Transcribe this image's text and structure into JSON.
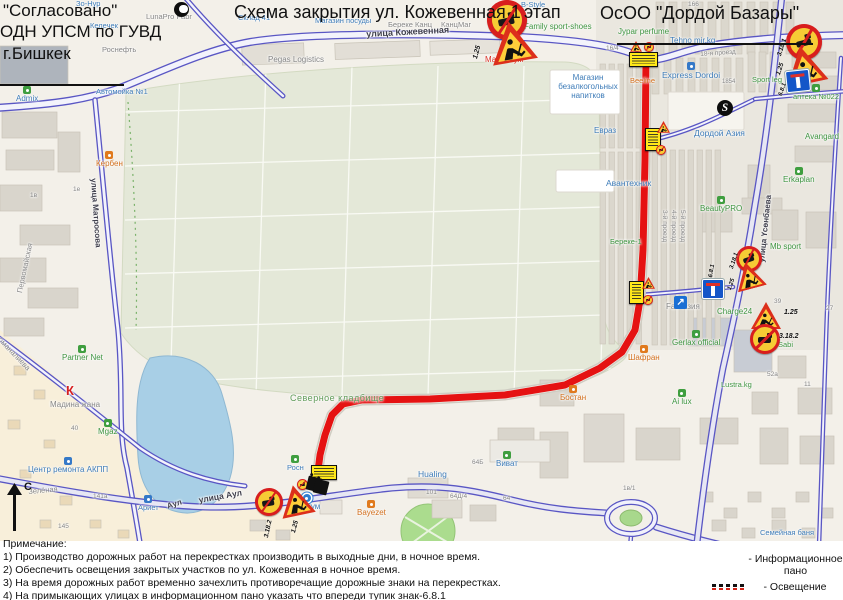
{
  "approval": {
    "line1": "\"Согласовано\"",
    "line2": "ОДН УПСМ по ГУВД",
    "line3": "г.Бишкек"
  },
  "scheme_title": {
    "part1": "Схема закрытия ул. Кожевенная 1",
    "part2": "этап"
  },
  "org_title": "ОсОО \"Дордой Базары\"",
  "compass": {
    "label": "С"
  },
  "notes": {
    "heading": "Примечание:",
    "items": [
      "1) Производство дорожных работ на перекрестках производить в выходные дни, в ночное время.",
      "2) Обеспечить освещения закрытых участков по ул. Кожевенная в ночное время.",
      "3) На время дорожных работ временно зачехлить противоречащие дорожные знаки на перекрестках.",
      "4) На примыкающих улицах в информационном пано указать что впереди тупик знак-6.8.1"
    ]
  },
  "legend": {
    "info_label": "- Информационное\nпано",
    "light_label": "-  Освещение",
    "panel1": "ВНИМАНИЕ!\nВ связи с ремонтными\nработами проезд\nЗАКРЫТ!\nПриносим извинения за\nвременные неудобства.",
    "panel2": "ВНИМАНИЕ!\nВ связи с ремонтными\nработами проезд по\nдругой стороне улицы.\nПриносим извинения за\nвременные неудобства."
  },
  "map": {
    "route": [
      [
        646,
        58
      ],
      [
        645,
        160
      ],
      [
        643,
        250
      ],
      [
        640,
        300
      ],
      [
        635,
        330
      ],
      [
        622,
        352
      ],
      [
        600,
        368
      ],
      [
        565,
        385
      ],
      [
        505,
        395
      ],
      [
        430,
        399
      ],
      [
        362,
        400
      ],
      [
        343,
        404
      ],
      [
        332,
        415
      ],
      [
        325,
        435
      ],
      [
        320,
        455
      ],
      [
        318,
        471
      ]
    ],
    "labels": [
      {
        "t": "Зо-Нур",
        "x": 76,
        "y": 0,
        "c": "blue",
        "s": 7.5
      },
      {
        "t": "LunaPro Fabr",
        "x": 146,
        "y": 13,
        "c": "gray",
        "s": 7.5
      },
      {
        "t": "Склад 41",
        "x": 238,
        "y": 14,
        "c": "blue",
        "s": 7.5
      },
      {
        "t": "Келечек",
        "x": 90,
        "y": 22,
        "c": "blue",
        "s": 7.5
      },
      {
        "t": "Роснефть",
        "x": 102,
        "y": 46,
        "c": "gray",
        "s": 7.5
      },
      {
        "t": "Автомойка №1",
        "x": 96,
        "y": 88,
        "c": "blue",
        "s": 7.5
      },
      {
        "t": "Admix",
        "x": 16,
        "y": 86,
        "c": "blue",
        "s": 8,
        "icon": "green"
      },
      {
        "t": "Магазин посуды",
        "x": 315,
        "y": 17,
        "c": "blue",
        "s": 7.5
      },
      {
        "t": "Береке Канц",
        "x": 388,
        "y": 21,
        "c": "gray",
        "s": 7.5
      },
      {
        "t": "КанцМаг",
        "x": 441,
        "y": 21,
        "c": "gray",
        "s": 7.5
      },
      {
        "t": "Pegas Logistics",
        "x": 268,
        "y": 56,
        "c": "gray",
        "s": 8
      },
      {
        "t": "Максимум",
        "x": 485,
        "y": 56,
        "c": "red",
        "s": 8
      },
      {
        "t": "B-Style",
        "x": 521,
        "y": 1,
        "c": "blue",
        "s": 7.5
      },
      {
        "t": "Family sport-shoes",
        "x": 524,
        "y": 23,
        "c": "green",
        "s": 8
      },
      {
        "t": "Jypar perfume",
        "x": 618,
        "y": 28,
        "c": "green",
        "s": 8
      },
      {
        "t": "Tehno mir.kg",
        "x": 670,
        "y": 37,
        "c": "blue",
        "s": 8
      },
      {
        "t": "Express Dordoi",
        "x": 662,
        "y": 62,
        "c": "blue",
        "s": 8.5,
        "icon": "blue"
      },
      {
        "t": "Beeline",
        "x": 630,
        "y": 77,
        "c": "orange",
        "s": 7.5
      },
      {
        "t": "Магазин\nбезалкогольных\nнапитков",
        "x": 550,
        "y": 74,
        "c": "blue",
        "s": 8,
        "w": 76
      },
      {
        "t": "аптека №022",
        "x": 793,
        "y": 84,
        "c": "green",
        "s": 7.5,
        "icon": "green"
      },
      {
        "t": "Sport leg",
        "x": 752,
        "y": 76,
        "c": "green",
        "s": 7.5
      },
      {
        "t": "Avangard",
        "x": 805,
        "y": 133,
        "c": "green",
        "s": 8
      },
      {
        "t": "Erkaplan",
        "x": 783,
        "y": 167,
        "c": "green",
        "s": 8,
        "icon": "green"
      },
      {
        "t": "BeautyPRO",
        "x": 700,
        "y": 196,
        "c": "green",
        "s": 8,
        "icon": "green"
      },
      {
        "t": "Дордой Азия",
        "x": 694,
        "y": 129,
        "c": "blue",
        "s": 8.5
      },
      {
        "t": "Евраз",
        "x": 594,
        "y": 127,
        "c": "blue",
        "s": 8
      },
      {
        "t": "Авантехник",
        "x": 606,
        "y": 179,
        "c": "blue",
        "s": 8.5
      },
      {
        "t": "Береке-1",
        "x": 610,
        "y": 238,
        "c": "green",
        "s": 7.5
      },
      {
        "t": "Mb sport",
        "x": 770,
        "y": 243,
        "c": "green",
        "s": 8
      },
      {
        "t": "Fan Азия",
        "x": 666,
        "y": 303,
        "c": "gray",
        "s": 8
      },
      {
        "t": "Charge24",
        "x": 717,
        "y": 308,
        "c": "green",
        "s": 8
      },
      {
        "t": "Gerlax official",
        "x": 672,
        "y": 330,
        "c": "green",
        "s": 8,
        "icon": "green"
      },
      {
        "t": "Шафран",
        "x": 628,
        "y": 345,
        "c": "orange",
        "s": 8,
        "icon": "orange"
      },
      {
        "t": "Sabi",
        "x": 778,
        "y": 341,
        "c": "green",
        "s": 7.5
      },
      {
        "t": "Lustra.kg",
        "x": 721,
        "y": 381,
        "c": "green",
        "s": 7.5
      },
      {
        "t": "Ai lux",
        "x": 672,
        "y": 389,
        "c": "green",
        "s": 8,
        "icon": "green"
      },
      {
        "t": "Бостан",
        "x": 560,
        "y": 385,
        "c": "orange",
        "s": 8,
        "icon": "orange"
      },
      {
        "t": "Виват",
        "x": 496,
        "y": 451,
        "c": "blue",
        "s": 8,
        "icon": "green"
      },
      {
        "t": "Hualing",
        "x": 418,
        "y": 470,
        "c": "blue",
        "s": 8.5
      },
      {
        "t": "Bayezet",
        "x": 357,
        "y": 500,
        "c": "orange",
        "s": 8,
        "icon": "orange"
      },
      {
        "t": "Суйкум",
        "x": 293,
        "y": 494,
        "c": "blue",
        "s": 8,
        "icon": "bluedot"
      },
      {
        "t": "Северное кладбище",
        "x": 290,
        "y": 393,
        "c": "cem",
        "s": 9
      },
      {
        "t": "Росн",
        "x": 287,
        "y": 455,
        "c": "blue",
        "s": 7.5,
        "icon": "green"
      },
      {
        "t": "Partner Net",
        "x": 62,
        "y": 345,
        "c": "green",
        "s": 8,
        "icon": "green"
      },
      {
        "t": "Мадина жана",
        "x": 50,
        "y": 401,
        "c": "gray",
        "s": 8
      },
      {
        "t": "К",
        "x": 66,
        "y": 384,
        "c": "klogo",
        "s": 13
      },
      {
        "t": "Mgaz",
        "x": 98,
        "y": 419,
        "c": "green",
        "s": 8,
        "icon": "green"
      },
      {
        "t": "Центр ремонта АКПП",
        "x": 28,
        "y": 457,
        "c": "blue",
        "s": 8,
        "icon": "blue"
      },
      {
        "t": "Зелёная",
        "x": 28,
        "y": 488,
        "c": "gray",
        "s": 7.5,
        "rot": -5
      },
      {
        "t": "Ариет",
        "x": 138,
        "y": 495,
        "c": "blue",
        "s": 7.5,
        "icon": "blue"
      },
      {
        "t": "Кербен",
        "x": 96,
        "y": 151,
        "c": "orange",
        "s": 8,
        "icon": "orange"
      },
      {
        "t": "Семейная баня",
        "x": 760,
        "y": 529,
        "c": "blue",
        "s": 7.5
      },
      {
        "t": "Первомайская",
        "x": 16,
        "y": 292,
        "c": "gray",
        "s": 7.5,
        "rot": -78
      },
      {
        "t": "оманалиева",
        "x": 2,
        "y": 336,
        "c": "gray",
        "s": 7.5,
        "rot": 46
      },
      {
        "t": "улица Кожевенная",
        "x": 366,
        "y": 29,
        "c": "street",
        "s": 9,
        "rot": -3
      },
      {
        "t": "улица Аул",
        "x": 198,
        "y": 496,
        "c": "street",
        "s": 8.5,
        "rot": -10
      },
      {
        "t": "Аул",
        "x": 166,
        "y": 503,
        "c": "street",
        "s": 8,
        "rot": -18
      },
      {
        "t": "улица Матросова",
        "x": 97,
        "y": 178,
        "c": "street",
        "s": 8,
        "rot": 86
      },
      {
        "t": "улица Үсөнбаева",
        "x": 758,
        "y": 262,
        "c": "street",
        "s": 8,
        "rot": -84
      },
      {
        "t": "3-й проезд",
        "x": 668,
        "y": 210,
        "c": "gray",
        "s": 6.5,
        "rot": 90
      },
      {
        "t": "4-й проезд",
        "x": 677,
        "y": 210,
        "c": "gray",
        "s": 6.5,
        "rot": 90
      },
      {
        "t": "5-й проезд",
        "x": 686,
        "y": 210,
        "c": "gray",
        "s": 6.5,
        "rot": 90
      },
      {
        "t": "18-я проезд",
        "x": 700,
        "y": 51,
        "c": "gray",
        "s": 6.5,
        "rot": -4
      },
      {
        "t": "16/4",
        "x": 606,
        "y": 45,
        "c": "gray",
        "s": 6.5
      },
      {
        "t": "166",
        "x": 688,
        "y": 1,
        "c": "gray",
        "s": 6.5
      },
      {
        "t": "1854",
        "x": 722,
        "y": 79,
        "c": "gray",
        "s": 6
      },
      {
        "t": "64Б",
        "x": 472,
        "y": 459,
        "c": "gray",
        "s": 6.5
      },
      {
        "t": "64",
        "x": 503,
        "y": 495,
        "c": "gray",
        "s": 6.5
      },
      {
        "t": "101",
        "x": 426,
        "y": 489,
        "c": "gray",
        "s": 6.5
      },
      {
        "t": "64Д/4",
        "x": 450,
        "y": 493,
        "c": "gray",
        "s": 6.5
      },
      {
        "t": "1в/1",
        "x": 623,
        "y": 485,
        "c": "gray",
        "s": 6.5
      },
      {
        "t": "39",
        "x": 774,
        "y": 298,
        "c": "gray",
        "s": 6.5
      },
      {
        "t": "27",
        "x": 826,
        "y": 305,
        "c": "gray",
        "s": 6.5
      },
      {
        "t": "52а",
        "x": 767,
        "y": 371,
        "c": "gray",
        "s": 6.5
      },
      {
        "t": "11",
        "x": 804,
        "y": 381,
        "c": "gray",
        "s": 6.5
      },
      {
        "t": "141а",
        "x": 93,
        "y": 493,
        "c": "gray",
        "s": 6.5
      },
      {
        "t": "145",
        "x": 58,
        "y": 523,
        "c": "gray",
        "s": 6.5
      },
      {
        "t": "22/86",
        "x": 26,
        "y": 542,
        "c": "gray",
        "s": 6.5
      },
      {
        "t": "40",
        "x": 71,
        "y": 425,
        "c": "gray",
        "s": 6.5
      },
      {
        "t": "1в",
        "x": 30,
        "y": 192,
        "c": "gray",
        "s": 6.5
      },
      {
        "t": "1е",
        "x": 73,
        "y": 186,
        "c": "gray",
        "s": 6.5
      }
    ],
    "signs": [
      {
        "type": "circ",
        "x": 487,
        "y": 0,
        "s": 40,
        "rot": -12,
        "name": "no-maneuver-sign"
      },
      {
        "type": "tri",
        "x": 489,
        "y": 21,
        "s": 46,
        "rot": -10,
        "name": "roadworks-sign",
        "label": {
          "t": "1.25",
          "x": 472,
          "y": 58,
          "rot": -75,
          "s": 7
        }
      },
      {
        "type": "circ",
        "x": 786,
        "y": 24,
        "s": 36,
        "rot": -15,
        "name": "no-maneuver-sign",
        "label": {
          "t": "3.18.1",
          "x": 776,
          "y": 55,
          "rot": -72,
          "s": 6.5
        }
      },
      {
        "type": "tri",
        "x": 783,
        "y": 46,
        "s": 42,
        "rot": -12,
        "name": "roadworks-sign",
        "label": {
          "t": "1.25",
          "x": 775,
          "y": 74,
          "rot": -72,
          "s": 6.5
        }
      },
      {
        "type": "deadend",
        "x": 786,
        "y": 70,
        "s": 22,
        "rot": -6,
        "name": "dead-end-sign",
        "label": {
          "t": "6.8.1",
          "x": 778,
          "y": 95,
          "rot": -72,
          "s": 6
        }
      },
      {
        "type": "panel",
        "x": 629,
        "y": 52,
        "w": 27,
        "h": 13,
        "name": "info-panel"
      },
      {
        "type": "minitri",
        "x": 630,
        "y": 41,
        "s": 12,
        "name": "roadworks-sign"
      },
      {
        "type": "minicirc",
        "x": 644,
        "y": 42,
        "s": 10,
        "name": "no-maneuver-sign"
      },
      {
        "type": "panel",
        "x": 645,
        "y": 128,
        "w": 14,
        "h": 21,
        "name": "info-panel"
      },
      {
        "type": "minitri",
        "x": 657,
        "y": 121,
        "s": 13,
        "name": "roadworks-sign"
      },
      {
        "type": "minicirc",
        "x": 656,
        "y": 145,
        "s": 10,
        "name": "no-maneuver-sign"
      },
      {
        "type": "panel",
        "x": 629,
        "y": 281,
        "w": 13,
        "h": 21,
        "name": "info-panel"
      },
      {
        "type": "minitri",
        "x": 642,
        "y": 277,
        "s": 13,
        "name": "roadworks-sign"
      },
      {
        "type": "minicirc",
        "x": 643,
        "y": 295,
        "s": 10,
        "name": "no-maneuver-sign"
      },
      {
        "type": "bluearrow",
        "x": 674,
        "y": 296,
        "s": 13,
        "name": "direction-sign",
        "label": {
          "t": "↗",
          "inner": true
        }
      },
      {
        "type": "deadend",
        "x": 702,
        "y": 279,
        "s": 20,
        "name": "dead-end-sign",
        "label": {
          "t": "6.8.1",
          "x": 708,
          "y": 277,
          "rot": -80,
          "s": 6
        }
      },
      {
        "type": "circ",
        "x": 736,
        "y": 246,
        "s": 26,
        "rot": -18,
        "name": "no-maneuver-sign",
        "label": {
          "t": "3.18.1",
          "x": 729,
          "y": 268,
          "rot": -72,
          "s": 6
        }
      },
      {
        "type": "tri",
        "x": 734,
        "y": 262,
        "s": 30,
        "rot": -15,
        "name": "roadworks-sign",
        "label": {
          "t": "1.25",
          "x": 727,
          "y": 289,
          "rot": -72,
          "s": 6
        }
      },
      {
        "type": "tri",
        "x": 751,
        "y": 302,
        "s": 30,
        "name": "roadworks-sign",
        "label": {
          "t": "1.25",
          "x": 784,
          "y": 309,
          "s": 7
        }
      },
      {
        "type": "circ",
        "x": 750,
        "y": 324,
        "s": 30,
        "name": "no-maneuver-sign",
        "label": {
          "t": "3.18.2",
          "x": 779,
          "y": 333,
          "s": 7
        }
      },
      {
        "type": "panel",
        "x": 311,
        "y": 465,
        "w": 24,
        "h": 13,
        "name": "info-panel"
      },
      {
        "type": "minicirc",
        "x": 297,
        "y": 479,
        "s": 11,
        "name": "no-entry-sign"
      },
      {
        "type": "figure",
        "x": 307,
        "y": 477,
        "name": "worker-figure-icon"
      },
      {
        "type": "figure",
        "x": 314,
        "y": 480,
        "name": "worker-figure-icon"
      },
      {
        "type": "circ",
        "x": 255,
        "y": 488,
        "s": 28,
        "rot": -10,
        "name": "no-maneuver-sign",
        "label": {
          "t": "3.18.2",
          "x": 263,
          "y": 537,
          "rot": -78,
          "s": 6.5
        }
      },
      {
        "type": "tri",
        "x": 279,
        "y": 485,
        "s": 34,
        "rot": -12,
        "name": "roadworks-sign",
        "label": {
          "t": "1.25",
          "x": 290,
          "y": 532,
          "rot": -75,
          "s": 6.5
        }
      },
      {
        "type": "minitri",
        "x": 495,
        "y": 562,
        "s": 13,
        "name": "roadworks-sign"
      },
      {
        "type": "tri",
        "x": 536,
        "y": 557,
        "s": 20,
        "legend": 1,
        "name": "roadworks-sign",
        "label": {
          "t": "1.25",
          "x": 553,
          "y": 566,
          "s": 6.5
        }
      },
      {
        "type": "circ",
        "x": 560,
        "y": 557,
        "s": 19,
        "legend": 1,
        "name": "no-maneuver-sign",
        "label": {
          "t": "3.18.1",
          "x": 577,
          "y": 566,
          "s": 6.5
        }
      },
      {
        "type": "circ",
        "x": 592,
        "y": 557,
        "s": 19,
        "legend": 1,
        "name": "no-maneuver-sign",
        "label": {
          "t": "3.18.2",
          "x": 609,
          "y": 566,
          "s": 6.5
        }
      },
      {
        "type": "noentry",
        "x": 626,
        "y": 558,
        "s": 16,
        "legend": 1,
        "name": "no-entry-sign",
        "label": {
          "t": "3.1",
          "x": 643,
          "y": 566,
          "s": 6.5
        }
      },
      {
        "type": "deadend",
        "x": 651,
        "y": 554,
        "s": 22,
        "legend": 1,
        "name": "dead-end-sign",
        "label": {
          "t": "6.8.1",
          "x": 673,
          "y": 566,
          "s": 6.5
        }
      },
      {
        "type": "panelbig",
        "x": 684,
        "y": 549,
        "w": 31,
        "h": 28,
        "legend": 1,
        "name": "info-panel",
        "bind": "legend.panel1"
      },
      {
        "type": "panelbig",
        "x": 718,
        "y": 549,
        "w": 31,
        "h": 28,
        "legend": 1,
        "name": "info-panel",
        "bind": "legend.panel2"
      },
      {
        "type": "disc",
        "x": 174,
        "y": 2,
        "s": 15,
        "moon": true,
        "name": "lunapro-logo-icon"
      },
      {
        "type": "disc",
        "x": 717,
        "y": 100,
        "s": 16,
        "name": "s-logo-icon",
        "label": {
          "t": "S",
          "inner": true
        }
      }
    ]
  }
}
